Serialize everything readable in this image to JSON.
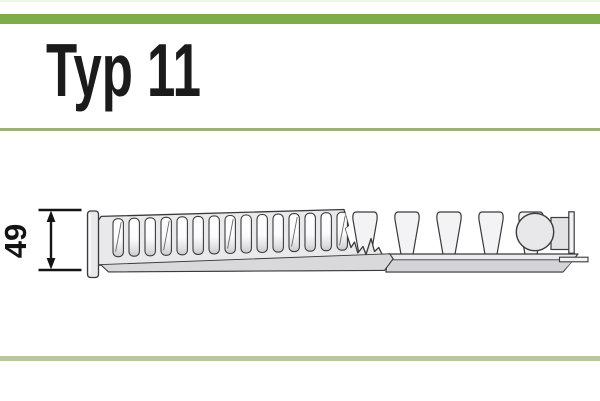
{
  "header": {
    "title": "Typ 11"
  },
  "diagram": {
    "name": "radiator-type-11-profile-drawing",
    "dimension": {
      "value": "49"
    },
    "grille_slot_count": 15,
    "convector_fin_count": 5
  },
  "colors": {
    "accent_band": "#7dad4a",
    "top_hairline": "#eef5e2",
    "title_underline": "#9ab179",
    "bottom_rule": "#b9c79e",
    "outline": "#3a3a3a",
    "ink": "#141414"
  }
}
